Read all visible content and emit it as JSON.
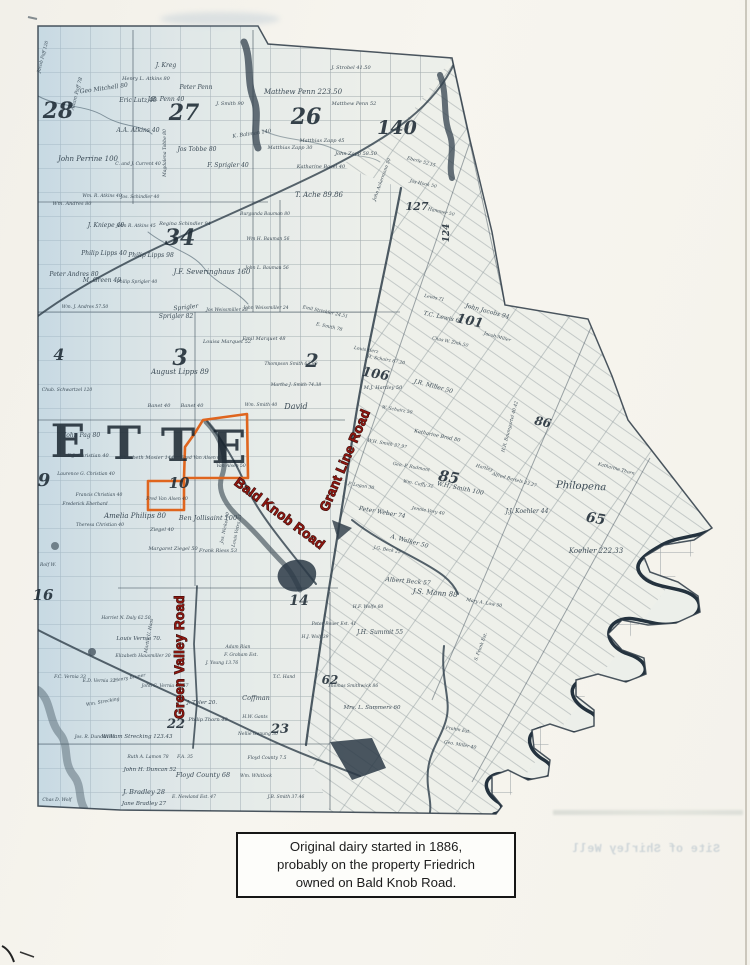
{
  "page": {
    "caption": {
      "lines": [
        "Original dairy started in 1886,",
        "probably on the property Friedrich",
        "owned on Bald Knob Road."
      ]
    },
    "bleed_text": "Site of Shirley Well"
  },
  "map": {
    "highlight_color": "#df651e",
    "annotation_color": "#8e1710",
    "township_letters": [
      {
        "t": "E",
        "x": 68,
        "y": 457
      },
      {
        "t": "T",
        "x": 124,
        "y": 459
      },
      {
        "t": "T",
        "x": 178,
        "y": 461
      },
      {
        "t": "E",
        "x": 229,
        "y": 463
      }
    ],
    "road_labels": [
      {
        "t": "Bald Knob Road",
        "x": 277,
        "y": 517,
        "r": 37
      },
      {
        "t": "Grant Line Road",
        "x": 349,
        "y": 462,
        "r": -67
      },
      {
        "t": "Green Valley Road",
        "x": 184,
        "y": 657,
        "r": -90
      }
    ],
    "section_numbers": [
      {
        "t": "28",
        "x": 58,
        "y": 118,
        "s": 22
      },
      {
        "t": "27",
        "x": 184,
        "y": 120,
        "s": 22
      },
      {
        "t": "26",
        "x": 306,
        "y": 124,
        "s": 22
      },
      {
        "t": "34",
        "x": 180,
        "y": 245,
        "s": 22
      },
      {
        "t": "3",
        "x": 180,
        "y": 365,
        "s": 22
      },
      {
        "t": "2",
        "x": 312,
        "y": 367,
        "s": 19
      },
      {
        "t": "4",
        "x": 59,
        "y": 360,
        "s": 16
      },
      {
        "t": "9",
        "x": 44,
        "y": 486,
        "s": 18
      },
      {
        "t": "10",
        "x": 179,
        "y": 488,
        "s": 15
      },
      {
        "t": "16",
        "x": 43,
        "y": 600,
        "s": 15
      },
      {
        "t": "140",
        "x": 397,
        "y": 134,
        "s": 19
      },
      {
        "t": "127",
        "x": 417,
        "y": 210,
        "s": 11
      },
      {
        "t": "124",
        "x": 449,
        "y": 233,
        "s": 9,
        "r": -90
      },
      {
        "t": "101",
        "x": 469,
        "y": 325,
        "s": 13,
        "r": 12
      },
      {
        "t": "106",
        "x": 375,
        "y": 378,
        "s": 13,
        "r": 10
      },
      {
        "t": "85",
        "x": 448,
        "y": 482,
        "s": 15,
        "r": 10
      },
      {
        "t": "86",
        "x": 542,
        "y": 426,
        "s": 12,
        "r": 12
      },
      {
        "t": "65",
        "x": 595,
        "y": 523,
        "s": 14,
        "r": 10
      },
      {
        "t": "62",
        "x": 330,
        "y": 684,
        "s": 12
      },
      {
        "t": "22",
        "x": 176,
        "y": 728,
        "s": 13
      },
      {
        "t": "23",
        "x": 280,
        "y": 733,
        "s": 13
      },
      {
        "t": "14",
        "x": 299,
        "y": 605,
        "s": 14
      }
    ],
    "parcel_labels": [
      {
        "t": "Jacob Paff 120",
        "x": 44,
        "y": 57,
        "r": -75,
        "s": 4.5
      },
      {
        "t": "Adam Paff 78",
        "x": 78,
        "y": 94,
        "r": -75,
        "s": 5
      },
      {
        "t": "Geo Mitchell 80",
        "x": 104,
        "y": 90,
        "r": -8
      },
      {
        "t": "J. Kreg",
        "x": 166,
        "y": 67
      },
      {
        "t": "Henry L. Atkins 80",
        "x": 146,
        "y": 80,
        "s": 5
      },
      {
        "t": "Eric Lutz 40",
        "x": 138,
        "y": 102
      },
      {
        "t": "J.B. Penn 40",
        "x": 166,
        "y": 101
      },
      {
        "t": "Peter Penn",
        "x": 196,
        "y": 89
      },
      {
        "t": "J. Smith 90",
        "x": 230,
        "y": 105,
        "s": 5
      },
      {
        "t": "A.A. Atkins 40",
        "x": 138,
        "y": 132
      },
      {
        "t": "Magdalena Tobbe 80",
        "x": 166,
        "y": 153,
        "r": -90,
        "s": 4.5
      },
      {
        "t": "Jos Tobbe 80",
        "x": 197,
        "y": 151
      },
      {
        "t": "John Perrine 100",
        "x": 88,
        "y": 161,
        "s": 7
      },
      {
        "t": "C. and J. Current 40",
        "x": 138,
        "y": 165,
        "s": 4.5
      },
      {
        "t": "F. Sprigler 40",
        "x": 228,
        "y": 167
      },
      {
        "t": "K. Baliman 140",
        "x": 252,
        "y": 135,
        "r": -8,
        "s": 5
      },
      {
        "t": "Matthew Penn 223.50",
        "x": 303,
        "y": 94,
        "s": 7
      },
      {
        "t": "J. Strobel 41.50",
        "x": 351,
        "y": 69,
        "s": 5
      },
      {
        "t": "Matthew Penn 52",
        "x": 354,
        "y": 105,
        "s": 5
      },
      {
        "t": "Matthias Zapp 45",
        "x": 322,
        "y": 142,
        "s": 5
      },
      {
        "t": "Matthias Zapp 30",
        "x": 290,
        "y": 149,
        "s": 5
      },
      {
        "t": "John Zapp 58.50",
        "x": 356,
        "y": 155,
        "s": 5
      },
      {
        "t": "Katharine Basel 40",
        "x": 321,
        "y": 168,
        "s": 5
      },
      {
        "t": "T. Ache 89.86",
        "x": 319,
        "y": 197,
        "s": 7
      },
      {
        "t": "John Ackermann 50",
        "x": 383,
        "y": 180,
        "r": -70,
        "s": 4.5
      },
      {
        "t": "Eberle 52.15",
        "x": 421,
        "y": 163,
        "r": 15,
        "s": 4.5
      },
      {
        "t": "Jos Hook 50",
        "x": 423,
        "y": 185,
        "r": 12,
        "s": 4.5
      },
      {
        "t": "Hammer 50",
        "x": 441,
        "y": 213,
        "r": 12,
        "s": 4.5
      },
      {
        "t": "Wm. Andres 80",
        "x": 72,
        "y": 205,
        "s": 5
      },
      {
        "t": "Wm. R. Atkins 40",
        "x": 102,
        "y": 197,
        "s": 4.5
      },
      {
        "t": "Jos. Schindler 40",
        "x": 140,
        "y": 198,
        "s": 4.5
      },
      {
        "t": "J. Kniepe 40",
        "x": 106,
        "y": 227
      },
      {
        "t": "John R. Atkins 45",
        "x": 136,
        "y": 227,
        "s": 4.5
      },
      {
        "t": "Regina Schindler 94",
        "x": 185,
        "y": 225,
        "s": 5
      },
      {
        "t": "Philip Lipps 40",
        "x": 104,
        "y": 255
      },
      {
        "t": "Philip Lipps 98",
        "x": 151,
        "y": 257
      },
      {
        "t": "Peter Andres 80",
        "x": 74,
        "y": 276
      },
      {
        "t": "M. Green 40",
        "x": 102,
        "y": 282
      },
      {
        "t": "Philip Sprigler 40",
        "x": 137,
        "y": 283,
        "s": 4.5
      },
      {
        "t": "J.F. Severinghaus 160",
        "x": 212,
        "y": 274,
        "s": 7
      },
      {
        "t": "Burgunda Bauman 80",
        "x": 265,
        "y": 215,
        "s": 4.5
      },
      {
        "t": "Wm H. Bauman 56",
        "x": 268,
        "y": 240,
        "s": 4.5
      },
      {
        "t": "John L. Bauman 56",
        "x": 267,
        "y": 269,
        "s": 4.5
      },
      {
        "t": "Wm. J. Andres 57.50",
        "x": 85,
        "y": 308,
        "s": 4.5
      },
      {
        "t": "Sprigler",
        "x": 186,
        "y": 309,
        "r": -6
      },
      {
        "t": "Sprigler 82",
        "x": 176,
        "y": 318
      },
      {
        "t": "Jos Weissmiller 28",
        "x": 227,
        "y": 311,
        "s": 4.5
      },
      {
        "t": "John Weissmiller 24",
        "x": 266,
        "y": 309,
        "s": 4.5
      },
      {
        "t": "Louisa Marquet 52",
        "x": 227,
        "y": 343,
        "s": 5
      },
      {
        "t": "Emil Marquet 48",
        "x": 264,
        "y": 340,
        "s": 5
      },
      {
        "t": "August Lipps 89",
        "x": 180,
        "y": 374,
        "s": 7
      },
      {
        "t": "Emil Strickler 24.51",
        "x": 325,
        "y": 313,
        "r": 12,
        "s": 4.5
      },
      {
        "t": "E. Smith 78",
        "x": 329,
        "y": 328,
        "r": 12,
        "s": 4.5
      },
      {
        "t": "Thompson Smith 63.90",
        "x": 291,
        "y": 365,
        "s": 4.5
      },
      {
        "t": "Martha J. Smith 74.38",
        "x": 296,
        "y": 386,
        "s": 4.5
      },
      {
        "t": "David",
        "x": 296,
        "y": 409,
        "s": 8
      },
      {
        "t": "Banet 40",
        "x": 159,
        "y": 407,
        "s": 5
      },
      {
        "t": "Banet 40",
        "x": 192,
        "y": 407,
        "s": 5
      },
      {
        "t": "Wm. Smith 40",
        "x": 261,
        "y": 406,
        "s": 4.5
      },
      {
        "t": "Chub. Schwartzel 120",
        "x": 67,
        "y": 391,
        "s": 4.5
      },
      {
        "t": "John Pag 80",
        "x": 82,
        "y": 437
      },
      {
        "t": "E.J. Christian 40",
        "x": 88,
        "y": 457,
        "s": 5
      },
      {
        "t": "Laurence G. Christian 40",
        "x": 86,
        "y": 475,
        "s": 4.5
      },
      {
        "t": "Francis Christian 40",
        "x": 99,
        "y": 496,
        "s": 4.5
      },
      {
        "t": "Frederick Eberhard",
        "x": 85,
        "y": 505,
        "s": 4.5
      },
      {
        "t": "Theresa Christian 40",
        "x": 100,
        "y": 526,
        "s": 4.5
      },
      {
        "t": "Amelia Philips 80",
        "x": 135,
        "y": 518,
        "s": 7
      },
      {
        "t": "Elizabeth Mosier 144",
        "x": 147,
        "y": 459,
        "s": 5
      },
      {
        "t": "Fred Van Alsen 61",
        "x": 202,
        "y": 459,
        "s": 4.5
      },
      {
        "t": "Van Alsen 50",
        "x": 231,
        "y": 467,
        "s": 4.5
      },
      {
        "t": "Fred Van Alsen 40",
        "x": 167,
        "y": 500,
        "s": 4.5
      },
      {
        "t": "Ben Jollisaint 100",
        "x": 208,
        "y": 520,
        "s": 6.5
      },
      {
        "t": "Ziegel 40",
        "x": 162,
        "y": 531,
        "s": 5
      },
      {
        "t": "Margaret Ziegel 50",
        "x": 173,
        "y": 550,
        "s": 5
      },
      {
        "t": "Frank Riess 53",
        "x": 218,
        "y": 552,
        "s": 5
      },
      {
        "t": "Jos. Nickel 50",
        "x": 226,
        "y": 528,
        "r": -78,
        "s": 4.5
      },
      {
        "t": "Louis Vetra 33",
        "x": 238,
        "y": 531,
        "r": -78,
        "s": 4.5
      },
      {
        "t": "T.C. Lewis 61",
        "x": 443,
        "y": 319,
        "r": 12
      },
      {
        "t": "John Jacobs 94",
        "x": 487,
        "y": 313,
        "r": 15
      },
      {
        "t": "Chas W. Zink 50",
        "x": 450,
        "y": 343,
        "r": 12,
        "s": 4.5
      },
      {
        "t": "Jacob Miller",
        "x": 497,
        "y": 338,
        "r": 15,
        "s": 4.5
      },
      {
        "t": "Louis Herz",
        "x": 366,
        "y": 351,
        "r": 10,
        "s": 4.5
      },
      {
        "t": "H. Schairz 67.20",
        "x": 386,
        "y": 361,
        "r": 10,
        "s": 4.5
      },
      {
        "t": "M.J. Hartley 50",
        "x": 383,
        "y": 389,
        "s": 5
      },
      {
        "t": "J.R. Miller 50",
        "x": 433,
        "y": 388,
        "r": 15
      },
      {
        "t": "W. Schairz 50",
        "x": 397,
        "y": 411,
        "r": 10,
        "s": 4.5
      },
      {
        "t": "W.H. Smith 37.97",
        "x": 387,
        "y": 445,
        "r": 10,
        "s": 4.5
      },
      {
        "t": "Katharine Brod 80",
        "x": 437,
        "y": 437,
        "r": 12,
        "s": 5
      },
      {
        "t": "Geo. P. Rudmant",
        "x": 411,
        "y": 468,
        "r": 10,
        "s": 4.5
      },
      {
        "t": "Wm. Caffy 32",
        "x": 418,
        "y": 485,
        "r": 10,
        "s": 4.5
      },
      {
        "t": "W.H. Smith 100",
        "x": 460,
        "y": 490,
        "r": 12
      },
      {
        "t": "Jennie Very 40",
        "x": 428,
        "y": 512,
        "r": 10,
        "s": 4.5
      },
      {
        "t": "Peter Weber 74",
        "x": 382,
        "y": 514,
        "r": 10
      },
      {
        "t": "A. Walker 50",
        "x": 409,
        "y": 543,
        "r": 15
      },
      {
        "t": "J.G. Beck 25",
        "x": 387,
        "y": 551,
        "r": 10,
        "s": 4.5
      },
      {
        "t": "P. Logan 30",
        "x": 361,
        "y": 487,
        "r": 10,
        "s": 4.5
      },
      {
        "t": "Hartley",
        "x": 484,
        "y": 469,
        "r": 15,
        "s": 4.5
      },
      {
        "t": "Alfred Bartels 23.27",
        "x": 514,
        "y": 481,
        "r": 15,
        "s": 4.5
      },
      {
        "t": "H.R. Baumgartel 40.42",
        "x": 511,
        "y": 427,
        "r": -75,
        "s": 4.5
      },
      {
        "t": "J.J. Koehler 44",
        "x": 527,
        "y": 513
      },
      {
        "t": "Philopena",
        "x": 581,
        "y": 489,
        "r": 3,
        "s": 10
      },
      {
        "t": "Katharine Thorn",
        "x": 616,
        "y": 470,
        "r": 15,
        "s": 4.5
      },
      {
        "t": "Koehler 222.33",
        "x": 596,
        "y": 553,
        "s": 7
      },
      {
        "t": "Lewis 71",
        "x": 434,
        "y": 299,
        "r": 12,
        "s": 4.5
      },
      {
        "t": "Albert Beck 57",
        "x": 408,
        "y": 583,
        "r": 5
      },
      {
        "t": "J.S. Mann 88",
        "x": 435,
        "y": 595,
        "r": 5,
        "s": 7
      },
      {
        "t": "H.F. Wolfe 60",
        "x": 368,
        "y": 608,
        "s": 4.5
      },
      {
        "t": "J.H. Summit 55",
        "x": 380,
        "y": 634
      },
      {
        "t": "Peter Bauer Est. 41",
        "x": 334,
        "y": 625,
        "s": 4.5
      },
      {
        "t": "H.J. Wolf 39",
        "x": 315,
        "y": 638,
        "s": 4.5
      },
      {
        "t": "Thomas Smithwick 86",
        "x": 353,
        "y": 687,
        "s": 4.5
      },
      {
        "t": "Mrs. L. Summers 60",
        "x": 372,
        "y": 709,
        "s": 5.5
      },
      {
        "t": "S. Frank Est.",
        "x": 482,
        "y": 647,
        "r": -70,
        "s": 4.5
      },
      {
        "t": "Mary A. Low 50",
        "x": 484,
        "y": 604,
        "r": 10,
        "s": 4.5
      },
      {
        "t": "Frahm Est.",
        "x": 458,
        "y": 731,
        "r": 10,
        "s": 4.5
      },
      {
        "t": "Geo. Miller 40",
        "x": 460,
        "y": 746,
        "r": 10,
        "s": 4.5
      },
      {
        "t": "Harriet N. Daly 62.50",
        "x": 126,
        "y": 619,
        "s": 4.5
      },
      {
        "t": "Louis Vernia 70.",
        "x": 139,
        "y": 640,
        "s": 5.5
      },
      {
        "t": "Elizabeth Hausmiller 30",
        "x": 143,
        "y": 657,
        "s": 4.5
      },
      {
        "t": "Henry Bruner",
        "x": 130,
        "y": 679,
        "r": -10,
        "s": 4.5
      },
      {
        "t": "John C. Vernia 47.57",
        "x": 165,
        "y": 687,
        "s": 4.5
      },
      {
        "t": "F.C. Vernia 33",
        "x": 70,
        "y": 678,
        "s": 4.5
      },
      {
        "t": "E.D. Vernia 32",
        "x": 99,
        "y": 682,
        "s": 4.5
      },
      {
        "t": "Wm. Strecking",
        "x": 103,
        "y": 703,
        "r": -10,
        "s": 4.5
      },
      {
        "t": "Rolf W.",
        "x": 48,
        "y": 566,
        "s": 4.5
      },
      {
        "t": "Martin U. Haas",
        "x": 150,
        "y": 636,
        "r": -80,
        "s": 4.5
      },
      {
        "t": "William Strecking 123.43",
        "x": 137,
        "y": 738,
        "s": 5.5
      },
      {
        "t": "Jos. R. Duncan 40",
        "x": 95,
        "y": 738,
        "s": 4.5
      },
      {
        "t": "Ruth A. Lamon 78",
        "x": 148,
        "y": 758,
        "s": 4.5
      },
      {
        "t": "John H. Duncan 52",
        "x": 150,
        "y": 771,
        "s": 5.5
      },
      {
        "t": "J. Bradley 28",
        "x": 144,
        "y": 794,
        "s": 6.5
      },
      {
        "t": "Jane Bradley 27",
        "x": 144,
        "y": 805,
        "s": 5.5
      },
      {
        "t": "E. Newland Est. 47",
        "x": 194,
        "y": 798,
        "s": 4.5
      },
      {
        "t": "Floyd County 68",
        "x": 203,
        "y": 777,
        "s": 6.5
      },
      {
        "t": "Floyd County 7.5",
        "x": 267,
        "y": 759,
        "s": 4.5
      },
      {
        "t": "Wm. Whitlock",
        "x": 256,
        "y": 777,
        "s": 4.5
      },
      {
        "t": "J.B. Smith 37.46",
        "x": 286,
        "y": 798,
        "s": 4.5
      },
      {
        "t": "Chas D. Wolf",
        "x": 57,
        "y": 801,
        "s": 4.5
      },
      {
        "t": "J. Tyler 20.",
        "x": 202,
        "y": 704,
        "s": 5.5
      },
      {
        "t": "Philip Thorn 40",
        "x": 208,
        "y": 721,
        "s": 5
      },
      {
        "t": "Coffman",
        "x": 256,
        "y": 700,
        "s": 6.5
      },
      {
        "t": "Nellie Genung 30",
        "x": 258,
        "y": 735,
        "s": 4.5
      },
      {
        "t": "H.W. Gants",
        "x": 255,
        "y": 718,
        "s": 4.5
      },
      {
        "t": "T.C. Hand",
        "x": 284,
        "y": 678,
        "s": 4.5
      },
      {
        "t": "F. Graham Est.",
        "x": 241,
        "y": 656,
        "s": 4.5
      },
      {
        "t": "Adam Rian",
        "x": 238,
        "y": 648,
        "s": 4.5
      },
      {
        "t": "J. Young 13.76",
        "x": 222,
        "y": 664,
        "s": 4.5
      },
      {
        "t": "F.A. 35",
        "x": 185,
        "y": 758,
        "s": 4.5
      }
    ]
  }
}
